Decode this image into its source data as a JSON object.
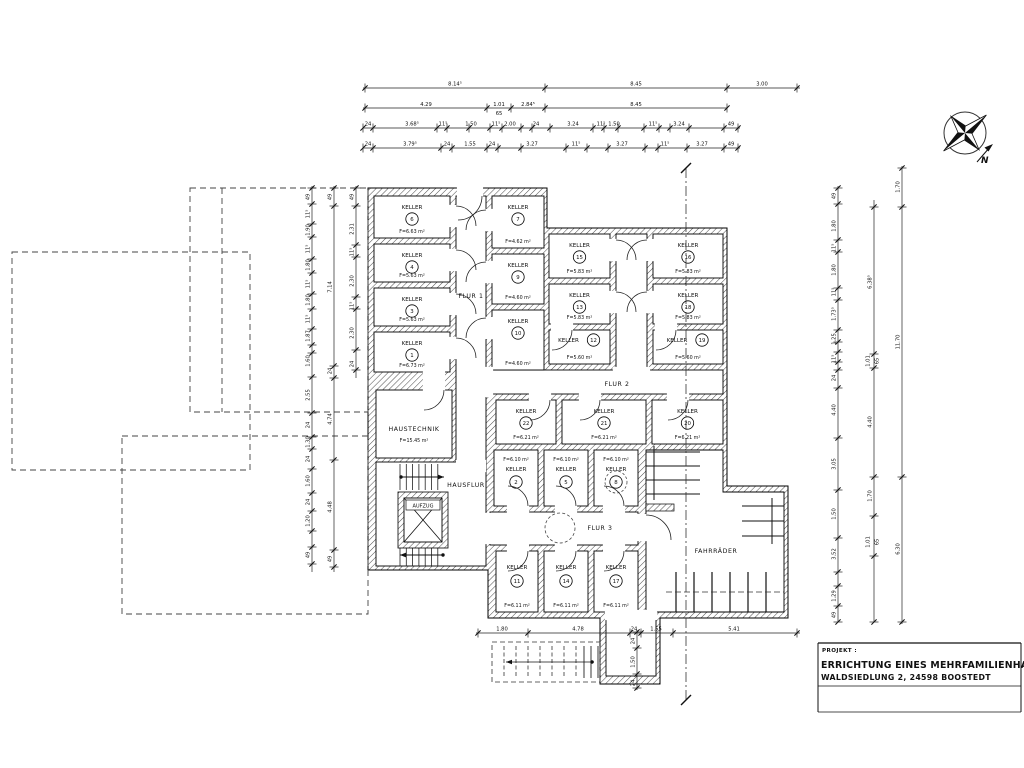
{
  "drawing": {
    "rooms": [
      {
        "name": "KELLER",
        "num": "6",
        "area": "F=6.63 m²"
      },
      {
        "name": "KELLER",
        "num": "4",
        "area": "F=5.63 m²"
      },
      {
        "name": "KELLER",
        "num": "3",
        "area": "F=5.63 m²"
      },
      {
        "name": "KELLER",
        "num": "1",
        "area": "F=6.73 m²"
      },
      {
        "name": "KELLER",
        "num": "7",
        "area": "F=4.62 m²"
      },
      {
        "name": "KELLER",
        "num": "9",
        "area": "F=4.60 m²"
      },
      {
        "name": "KELLER",
        "num": "10",
        "area": "F=4.60 m²"
      },
      {
        "name": "KELLER",
        "num": "15",
        "area": "F=5.83 m²"
      },
      {
        "name": "KELLER",
        "num": "13",
        "area": "F=5.83 m²"
      },
      {
        "name": "KELLER",
        "num": "12",
        "area": "F=5.60 m²"
      },
      {
        "name": "KELLER",
        "num": "16",
        "area": "F=5.83 m²"
      },
      {
        "name": "KELLER",
        "num": "18",
        "area": "F=5.83 m²"
      },
      {
        "name": "KELLER",
        "num": "19",
        "area": "F=5.60 m²"
      },
      {
        "name": "KELLER",
        "num": "22",
        "area": "F=6.21 m²"
      },
      {
        "name": "KELLER",
        "num": "21",
        "area": "F=6.21 m²"
      },
      {
        "name": "KELLER",
        "num": "20",
        "area": "F=6.21 m²"
      },
      {
        "name": "KELLER",
        "num": "2",
        "area": "F=6.10 m²"
      },
      {
        "name": "KELLER",
        "num": "5",
        "area": "F=6.10 m²"
      },
      {
        "name": "KELLER",
        "num": "8",
        "area": "F=6.10 m²"
      },
      {
        "name": "KELLER",
        "num": "11",
        "area": "F=6.11 m²"
      },
      {
        "name": "KELLER",
        "num": "14",
        "area": "F=6.11 m²"
      },
      {
        "name": "KELLER",
        "num": "17",
        "area": "F=6.11 m²"
      }
    ],
    "labels": {
      "flur1": "FLUR 1",
      "flur2": "FLUR 2",
      "flur3": "FLUR 3",
      "hausflur": "HAUSFLUR",
      "haustechnik": "HAUSTECHNIK",
      "haustechnik_area": "F=15.45 m²",
      "aufzug": "AUFZUG",
      "fahrraeder": "FAHRRÄDER",
      "north": "N"
    },
    "dims": {
      "top1": [
        "8.14⁵",
        "8.45",
        "3.00"
      ],
      "top2": [
        "4.29",
        "1.01",
        "65",
        "2.84⁵",
        "8.45"
      ],
      "top3": [
        "24",
        "3.68⁵",
        "11⁵",
        "1.50",
        "11⁵",
        "2.00",
        "24",
        "3.24",
        "11⁵",
        "1.50",
        "11⁵",
        "3.24",
        "49"
      ],
      "top4": [
        "24",
        "3.79⁵",
        "24",
        "1.55",
        "24",
        "3.27",
        "11⁵",
        "3.27",
        "11⁵",
        "3.27",
        "49"
      ],
      "bottom": [
        "1.80",
        "4.78",
        "24",
        "1.55",
        "5.41"
      ],
      "bottom_v": [
        "24",
        "1.50",
        "24"
      ],
      "left1": [
        "49",
        "11⁵",
        "1.90",
        "11⁵",
        "1.80",
        "11⁵",
        "1.80",
        "11⁵",
        "1.87",
        "1.60",
        "2.55",
        "24",
        "1.30",
        "24",
        "1.60",
        "24",
        "1.20",
        "49"
      ],
      "left2": [
        "49",
        "7.14",
        "24",
        "4.74",
        "4.48",
        "49"
      ],
      "left3": [
        "49",
        "2.31",
        "11⁵",
        "2.30",
        "11⁵",
        "2.30",
        "24"
      ],
      "right1": [
        "49",
        "1.80",
        "11⁵",
        "1.80",
        "11⁵",
        "1.73⁵",
        "1.25",
        "11⁵",
        "24",
        "4.40",
        "3.05",
        "1.50",
        "3.52",
        "1.29",
        "49"
      ],
      "right2": [
        "6.38⁵",
        "1.01",
        "65",
        "4.40",
        "1.70",
        "1.01",
        "65"
      ],
      "right3": [
        "1.70",
        "11.70",
        "6.30"
      ]
    },
    "title_block": {
      "project_label": "PROJEKT :",
      "line1": "ERRICHTUNG EINES MEHRFAMILIENHAUSE",
      "line2": "WALDSIEDLUNG 2, 24598 BOOSTEDT"
    }
  }
}
